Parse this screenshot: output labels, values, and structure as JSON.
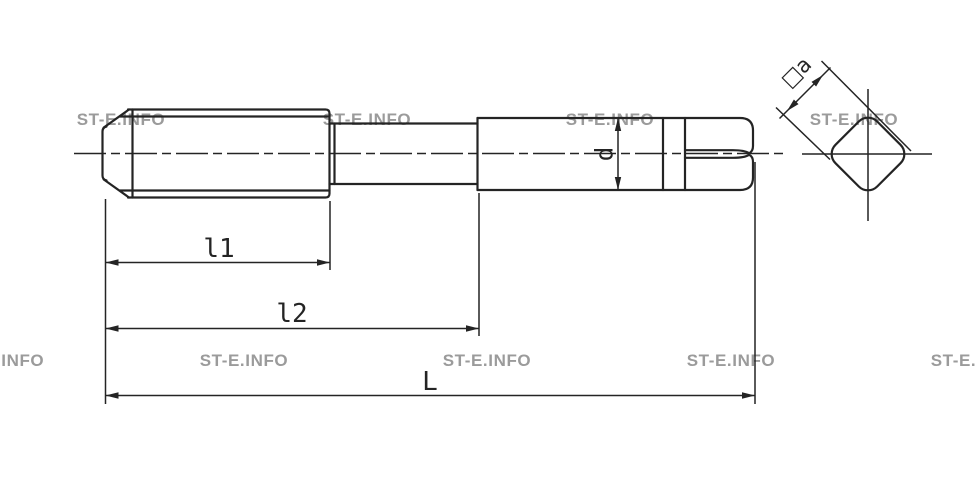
{
  "watermark": {
    "text": "ST-E.INFO",
    "color": "#9b9b9b"
  },
  "drawing": {
    "labels": {
      "l1": "l1",
      "l2": "l2",
      "L": "L",
      "d": "d",
      "square_a": "□a"
    },
    "colors": {
      "line": "#242424",
      "background": "#ffffff",
      "watermark": "#9b9b9b"
    }
  }
}
